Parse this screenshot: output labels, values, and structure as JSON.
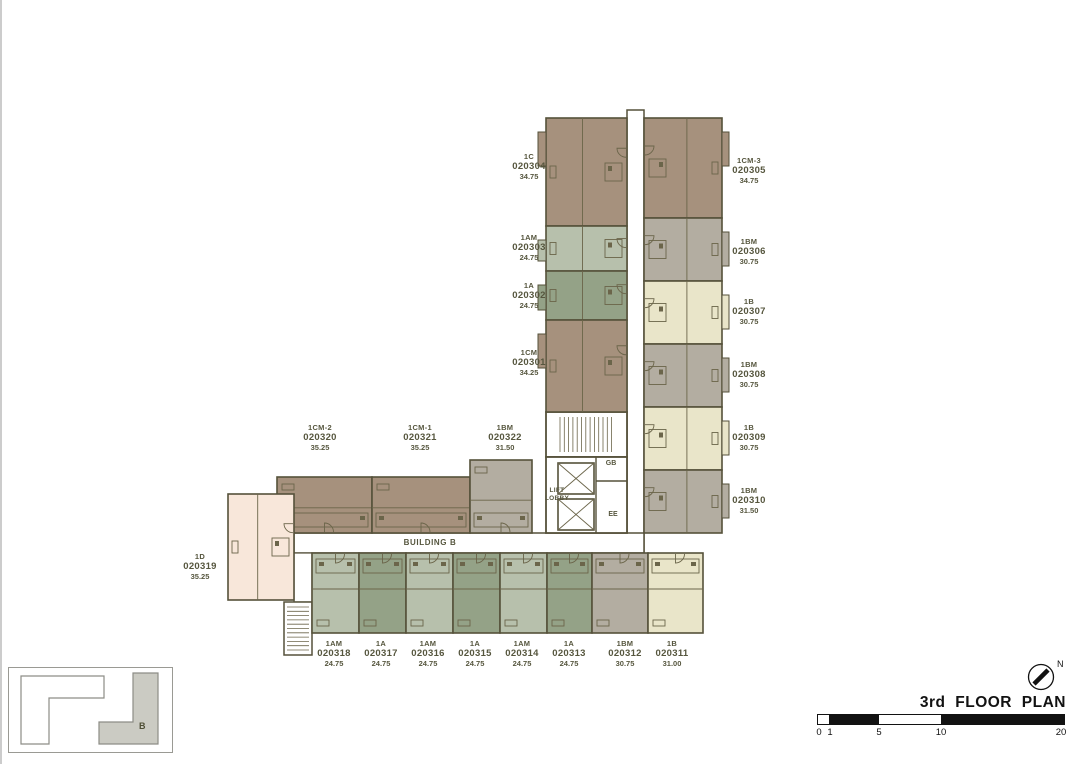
{
  "title_block": {
    "title": "3rd FLOOR PLAN",
    "north_label": "N",
    "scale_ticks": [
      "0",
      "1",
      "5",
      "10",
      "20"
    ]
  },
  "plan": {
    "building_label": "BUILDING B",
    "lift_lobby_line1": "LIFT",
    "lift_lobby_line2": "LOBBY",
    "room_gb": "GB",
    "room_ee": "EE"
  },
  "key_plan": {
    "building_b_label": "B"
  },
  "colors": {
    "wall": "#55513a",
    "detail": "#6b654a",
    "label_text": "#56563e",
    "unit_brown": "#a6917d",
    "unit_sage_light": "#b7c0ac",
    "unit_sage_dark": "#94a287",
    "unit_cream": "#e9e5c9",
    "unit_gray": "#b3ada1",
    "unit_pink": "#f8e7da"
  },
  "units": [
    {
      "type": "1CM",
      "no": "020301",
      "area": "34.25"
    },
    {
      "type": "1A",
      "no": "020302",
      "area": "24.75"
    },
    {
      "type": "1AM",
      "no": "020303",
      "area": "24.75"
    },
    {
      "type": "1C",
      "no": "020304",
      "area": "34.75"
    },
    {
      "type": "1CM-3",
      "no": "020305",
      "area": "34.75"
    },
    {
      "type": "1BM",
      "no": "020306",
      "area": "30.75"
    },
    {
      "type": "1B",
      "no": "020307",
      "area": "30.75"
    },
    {
      "type": "1BM",
      "no": "020308",
      "area": "30.75"
    },
    {
      "type": "1B",
      "no": "020309",
      "area": "30.75"
    },
    {
      "type": "1BM",
      "no": "020310",
      "area": "31.50"
    },
    {
      "type": "1B",
      "no": "020311",
      "area": "31.00"
    },
    {
      "type": "1BM",
      "no": "020312",
      "area": "30.75"
    },
    {
      "type": "1A",
      "no": "020313",
      "area": "24.75"
    },
    {
      "type": "1AM",
      "no": "020314",
      "area": "24.75"
    },
    {
      "type": "1A",
      "no": "020315",
      "area": "24.75"
    },
    {
      "type": "1AM",
      "no": "020316",
      "area": "24.75"
    },
    {
      "type": "1A",
      "no": "020317",
      "area": "24.75"
    },
    {
      "type": "1AM",
      "no": "020318",
      "area": "24.75"
    },
    {
      "type": "1D",
      "no": "020319",
      "area": "35.25"
    },
    {
      "type": "1CM-2",
      "no": "020320",
      "area": "35.25"
    },
    {
      "type": "1CM-1",
      "no": "020321",
      "area": "35.25"
    },
    {
      "type": "1BM",
      "no": "020322",
      "area": "31.50"
    }
  ]
}
